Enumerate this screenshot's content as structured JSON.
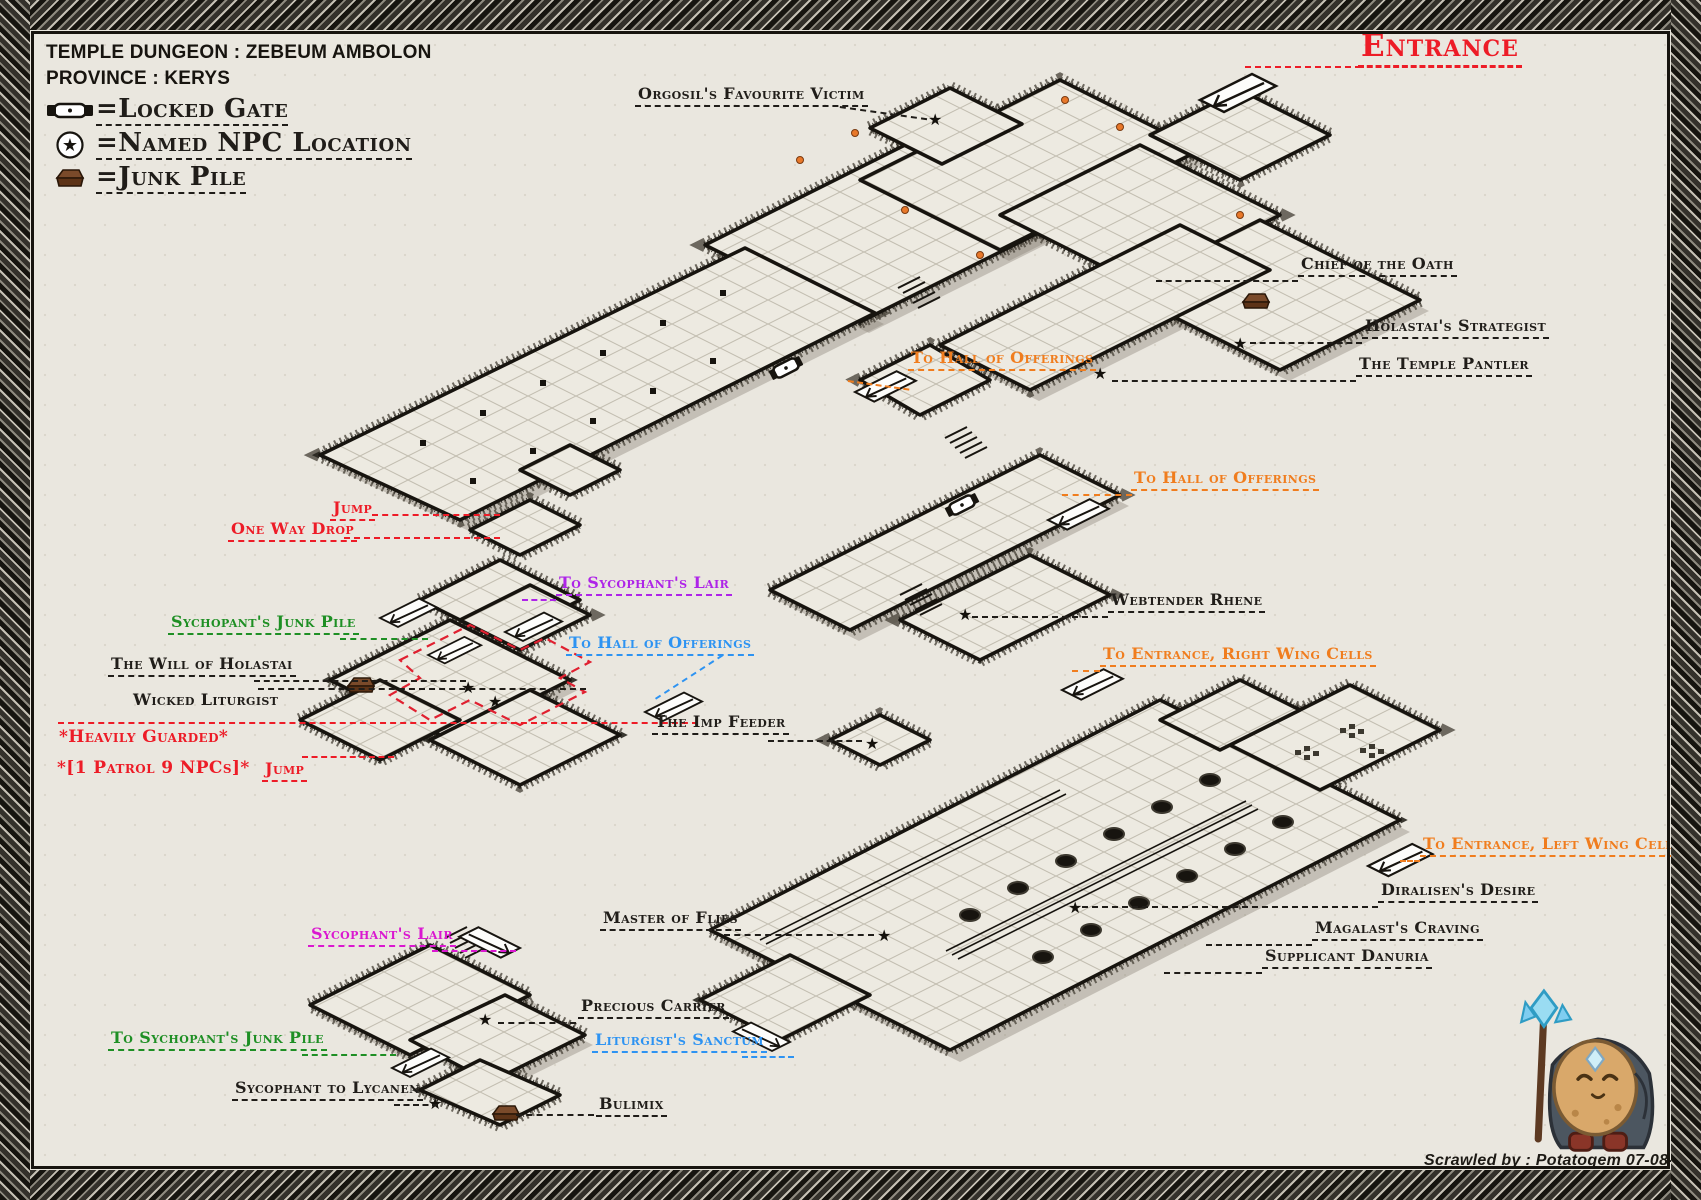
{
  "title": {
    "line1": "TEMPLE DUNGEON : ZEBEUM AMBOLON",
    "line2": "PROVINCE : KERYS"
  },
  "legend": {
    "items": [
      {
        "icon": "locked-gate-icon",
        "label": "=Locked Gate"
      },
      {
        "icon": "npc-star-icon",
        "label": "=Named NPC Location"
      },
      {
        "icon": "junk-pile-icon",
        "label": "=Junk Pile"
      }
    ]
  },
  "entrance": {
    "label": "Entrance"
  },
  "annotations": [
    {
      "text": "Orgosil's Favourite Victim",
      "color": "black"
    },
    {
      "text": "Chief of the Oath",
      "color": "black"
    },
    {
      "text": "Holastai's Strategist",
      "color": "black"
    },
    {
      "text": "The Temple Pantler",
      "color": "black"
    },
    {
      "text": "To Hall of Offerings",
      "color": "orange"
    },
    {
      "text": "To Hall of Offerings",
      "color": "orange"
    },
    {
      "text": "Webtender Rhene",
      "color": "black"
    },
    {
      "text": "Jump",
      "color": "red"
    },
    {
      "text": "One Way Drop",
      "color": "red"
    },
    {
      "text": "To Sycophant's Lair",
      "color": "purple"
    },
    {
      "text": "Sychopant's Junk Pile",
      "color": "green"
    },
    {
      "text": "The Will of Holastai",
      "color": "black"
    },
    {
      "text": "Wicked Liturgist",
      "color": "black"
    },
    {
      "text": "*Heavily Guarded*",
      "color": "red"
    },
    {
      "text": "*[1 Patrol 9 NPCs]*",
      "color": "red"
    },
    {
      "text": "Jump",
      "color": "red"
    },
    {
      "text": "To Hall of Offerings",
      "color": "blue"
    },
    {
      "text": "The Imp Feeder",
      "color": "black"
    },
    {
      "text": "To Entrance, Right Wing Cells",
      "color": "orange"
    },
    {
      "text": "To Entrance, Left Wing Cells",
      "color": "orange"
    },
    {
      "text": "Diralisen's Desire",
      "color": "black"
    },
    {
      "text": "Magalast's Craving",
      "color": "black"
    },
    {
      "text": "Supplicant Danuria",
      "color": "black"
    },
    {
      "text": "Master of Flies",
      "color": "black"
    },
    {
      "text": "Sycophant's Lair",
      "color": "magenta"
    },
    {
      "text": "To Sychopant's Junk Pile",
      "color": "green"
    },
    {
      "text": "Sycophant to Lycanen",
      "color": "black"
    },
    {
      "text": "Precious Carrier",
      "color": "black"
    },
    {
      "text": "Liturgist's Sanctum",
      "color": "blue"
    },
    {
      "text": "Bulimix",
      "color": "black"
    }
  ],
  "credit": "Scrawled by : Potatogem 07-08-2024",
  "colors": {
    "ink": "#201d19",
    "red": "#ed1c27",
    "orange": "#f07d1e",
    "green": "#1e8f24",
    "purple": "#ae24e8",
    "magenta": "#da18d0",
    "blue": "#2d93f2",
    "parchment": "#eae7df"
  }
}
